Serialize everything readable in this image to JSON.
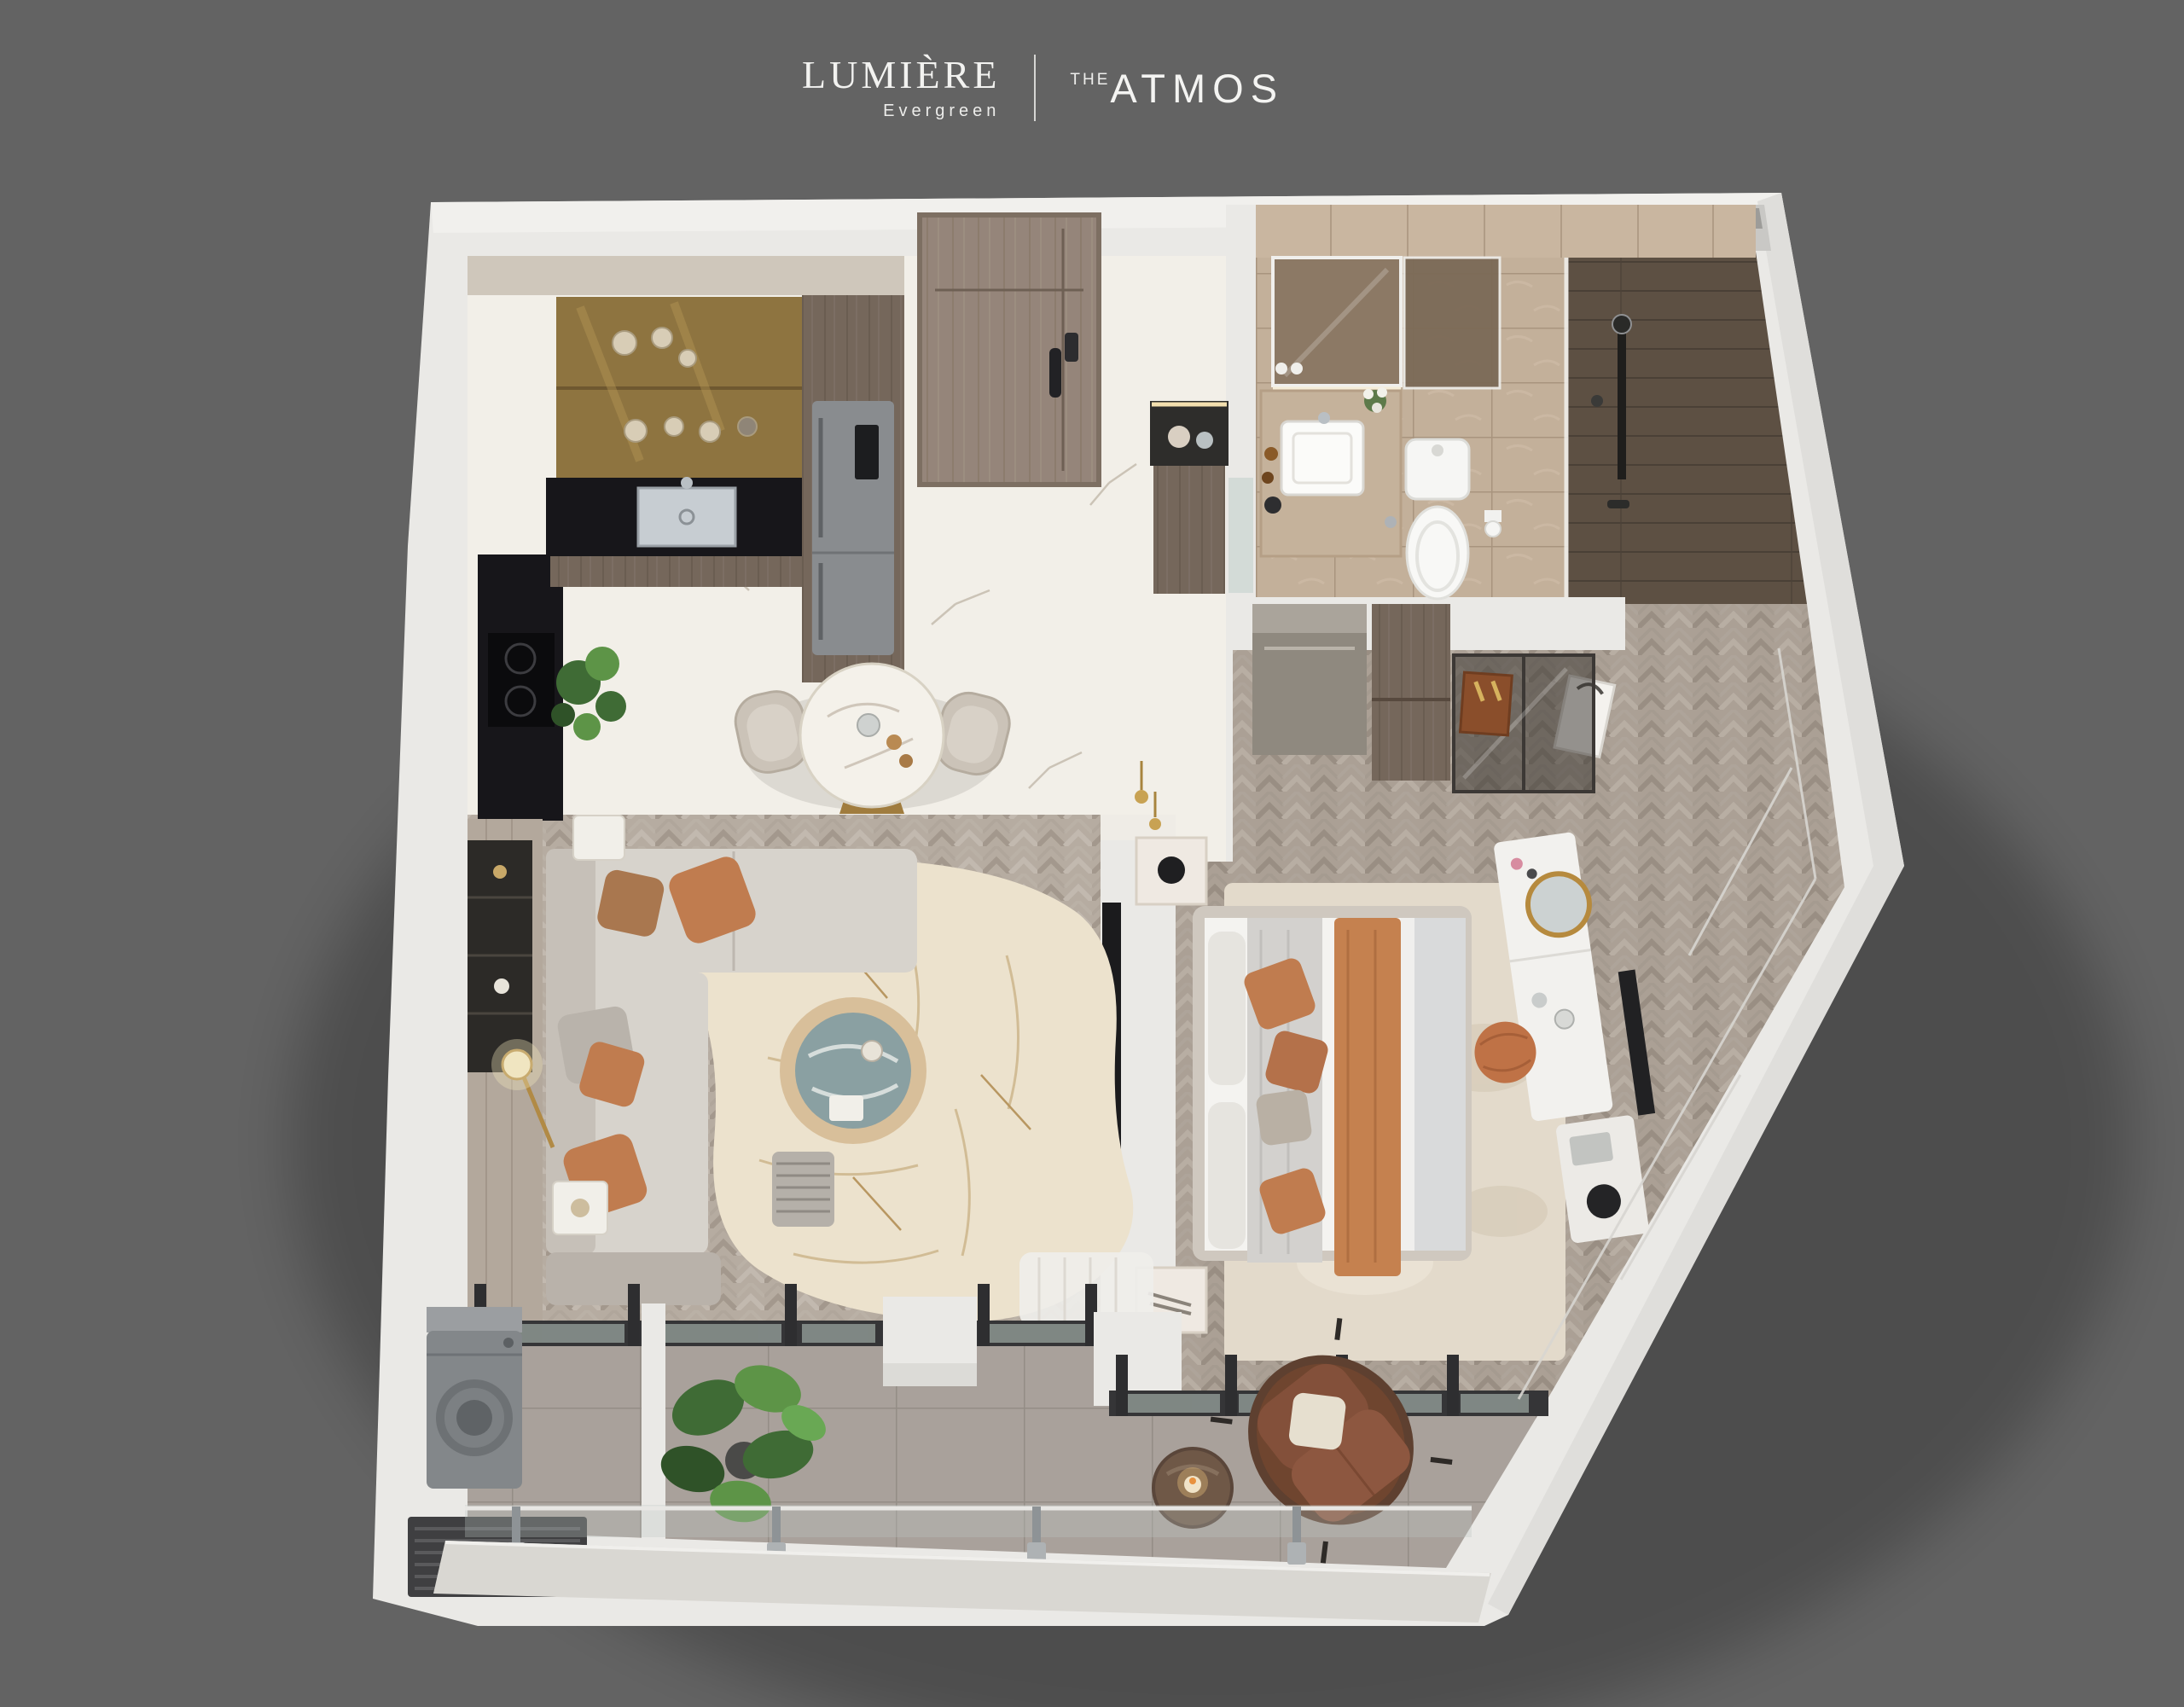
{
  "header": {
    "brand_primary": {
      "name": "LUMIÈRE",
      "subtitle": "Evergreen"
    },
    "divider": "|",
    "brand_secondary": {
      "prefix": "THE",
      "name": "ATMOS"
    }
  },
  "palette": {
    "bg": "#636363",
    "text_light": "#f2f2f0",
    "wall": "#eae9e6",
    "wall_shade": "#d6d4cf",
    "slab": "#d9d7d2",
    "marble": "#f2efe8",
    "marble_vein": "#bdb4a6",
    "wood_floor": "#b6aca1",
    "wood_floor_dark": "#aba095",
    "bath_tile": "#c3b09a",
    "bath_wall": "#c9b6a0",
    "shower_plank": "#5d5043",
    "balcony_tile": "#a9a19b",
    "kitchen_wood": "#75675b",
    "kitchen_counter": "#17161a",
    "brass_backsplash": "#8e7440",
    "gold": "#a07c3e",
    "fridge": "#898c8f",
    "door_wood": "#95857a",
    "sofa": "#d7d3cc",
    "sofa_shade": "#c6c0b8",
    "pillow_orange": "#c07c4f",
    "rug_cream": "#ece2cd",
    "table_marble": "#8aa0a2",
    "bed_sheet": "#f4f3f0",
    "duvet": "#d9dadb",
    "runner_orange": "#c5814f",
    "throw_gray": "#d3d1ce",
    "bedroom_rug": "#e3dacb",
    "white_furniture": "#f2f1ee",
    "frame_dark": "#353537",
    "glass": "#9aa5a0",
    "plant_green": "#3f6b35",
    "plant_green_light": "#5d9447",
    "rattan": "#6f452f",
    "cushion_brown": "#8a5138"
  }
}
